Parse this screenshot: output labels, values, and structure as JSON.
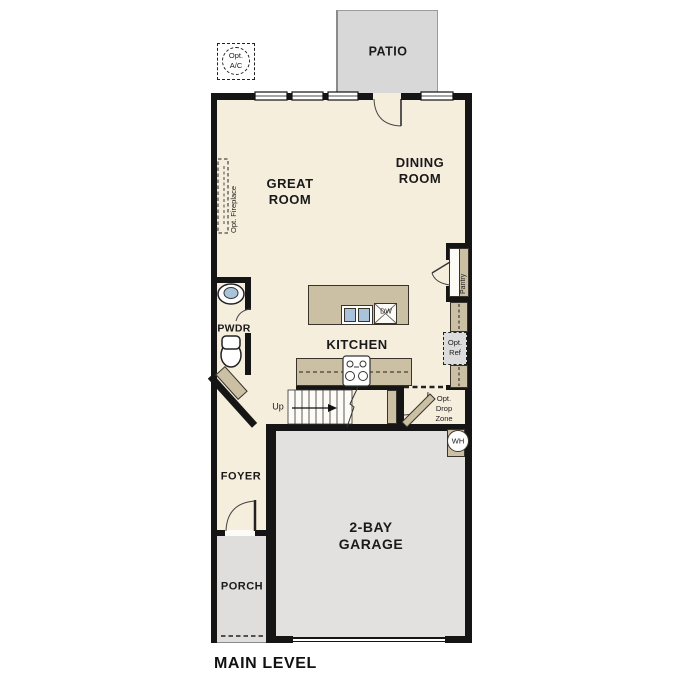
{
  "plan_title": "MAIN LEVEL",
  "rooms": {
    "patio": "PATIO",
    "great_room_l1": "GREAT",
    "great_room_l2": "ROOM",
    "dining_l1": "DINING",
    "dining_l2": "ROOM",
    "kitchen": "KITCHEN",
    "pwdr": "PWDR",
    "foyer": "FOYER",
    "porch": "PORCH",
    "garage_l1": "2-BAY",
    "garage_l2": "GARAGE"
  },
  "features": {
    "opt_ac_l1": "Opt.",
    "opt_ac_l2": "A/C",
    "opt_fireplace": "Opt. Fireplace",
    "pantry": "Pantry",
    "opt_ref_l1": "Opt.",
    "opt_ref_l2": "Ref",
    "opt_drop_l1": "Opt.",
    "opt_drop_l2": "Drop",
    "opt_drop_l3": "Zone",
    "water_heater": "WH",
    "dishwasher": "DW",
    "stairs_direction": "Up"
  },
  "colors": {
    "floor": "#f6eedd",
    "wall": "#151515",
    "cabinet_tan": "#cbbfa4",
    "garage_gray": "#e2e1df",
    "patio_gray": "#d8d8d8",
    "sink_blue": "#a9c4da",
    "opt_ref_gray": "#dcdcdc"
  }
}
